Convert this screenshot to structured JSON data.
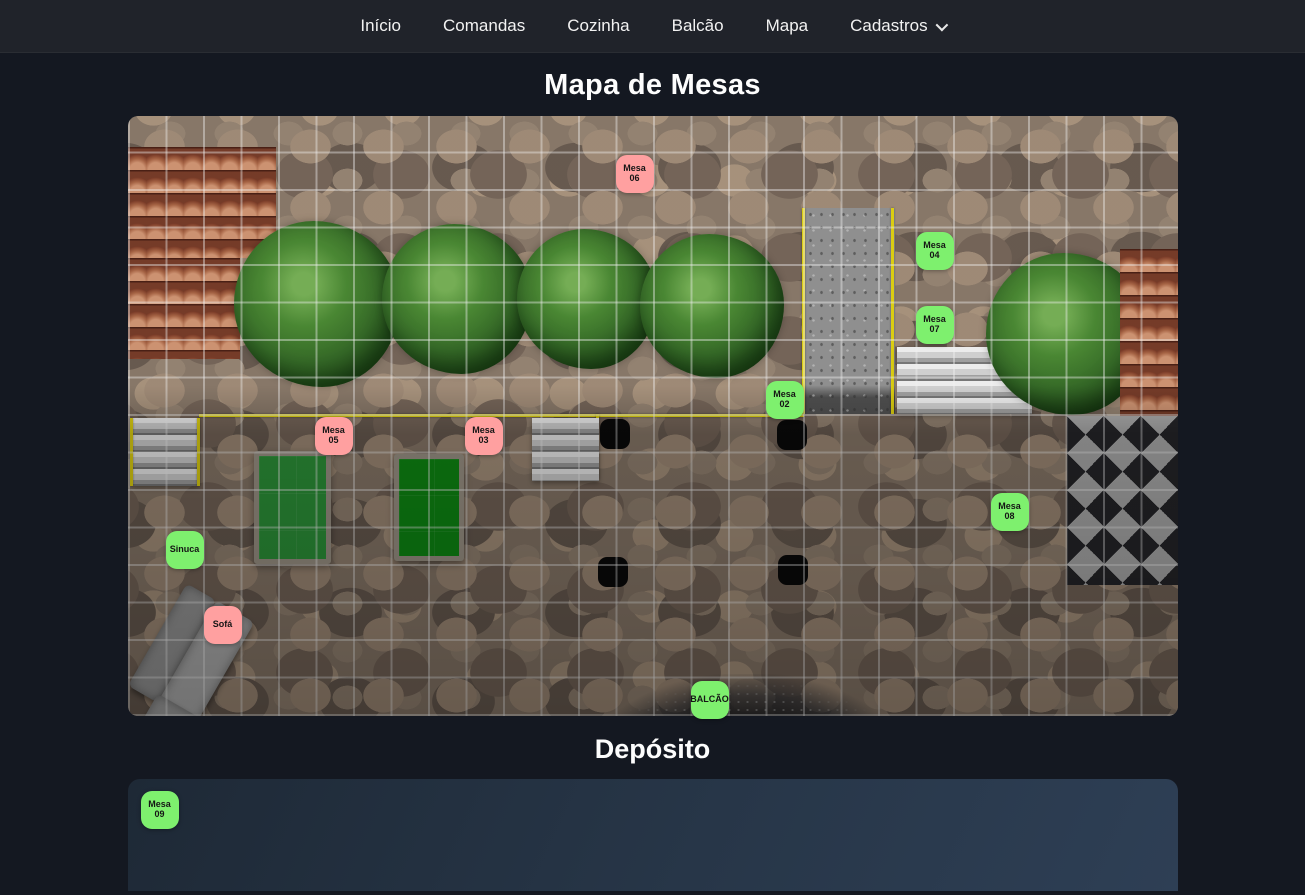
{
  "nav": {
    "items": [
      {
        "label": "Início",
        "dropdown": false
      },
      {
        "label": "Comandas",
        "dropdown": false
      },
      {
        "label": "Cozinha",
        "dropdown": false
      },
      {
        "label": "Balcão",
        "dropdown": false
      },
      {
        "label": "Mapa",
        "dropdown": false
      },
      {
        "label": "Cadastros",
        "dropdown": true
      }
    ]
  },
  "page": {
    "title": "Mapa de Mesas",
    "deposit_title": "Depósito"
  },
  "colors": {
    "free": "#7ef06e",
    "occupied": "#ffa0a0",
    "marker_text": "#151515"
  },
  "map": {
    "markers": [
      {
        "label": "Mesa 06",
        "status": "occupied",
        "x": 488,
        "y": 39
      },
      {
        "label": "Mesa 04",
        "status": "free",
        "x": 788,
        "y": 116
      },
      {
        "label": "Mesa 07",
        "status": "free",
        "x": 788,
        "y": 190
      },
      {
        "label": "Mesa 02",
        "status": "free",
        "x": 638,
        "y": 265
      },
      {
        "label": "Mesa 05",
        "status": "occupied",
        "x": 187,
        "y": 301
      },
      {
        "label": "Mesa 03",
        "status": "occupied",
        "x": 337,
        "y": 301
      },
      {
        "label": "Mesa 08",
        "status": "free",
        "x": 863,
        "y": 377
      },
      {
        "label": "Sinuca",
        "status": "free",
        "x": 38,
        "y": 415
      },
      {
        "label": "Sofá",
        "status": "occupied",
        "x": 76,
        "y": 490
      },
      {
        "label": "BALCÃO",
        "status": "free",
        "x": 563,
        "y": 565
      }
    ]
  },
  "deposit": {
    "markers": [
      {
        "label": "Mesa 09",
        "status": "free",
        "x": 13,
        "y": 12
      }
    ]
  }
}
